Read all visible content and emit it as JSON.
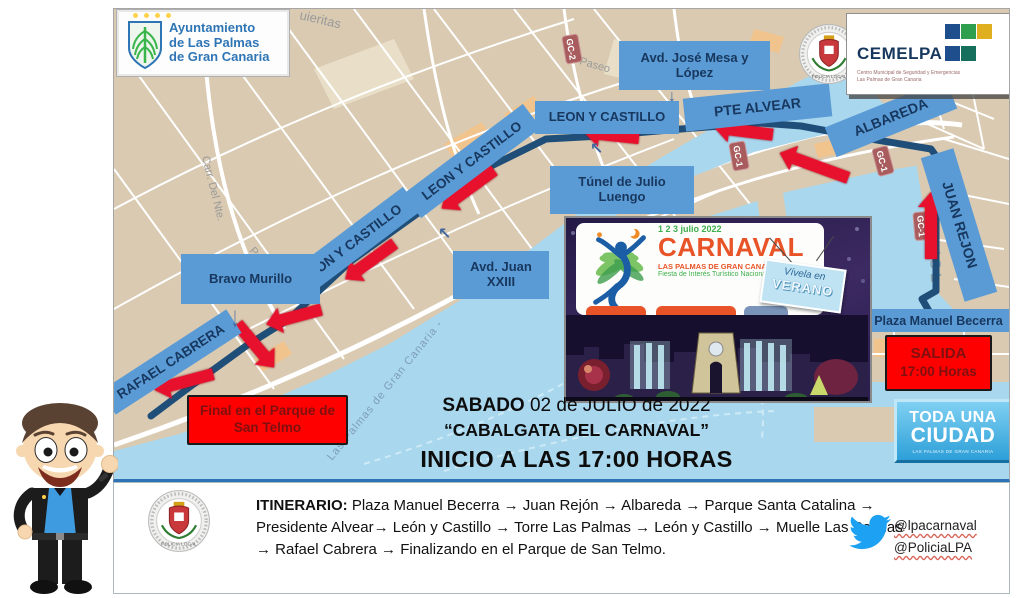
{
  "header": {
    "ayuntamiento": {
      "line1": "Ayuntamiento",
      "line2": "de Las Palmas",
      "line3": "de Gran Canaria"
    },
    "cemelpa": {
      "name": "CEMELPA",
      "subtitle": "Centro Municipal de Seguridad y Emergencias Las Palmas de Gran Canaria"
    }
  },
  "map": {
    "street_labels": {
      "top": "uieritas",
      "carretera": "Carr. Del Nte.",
      "paseo": "Paseo",
      "watermark": "Las Palmas de Gran Canaria -",
      "isleta": "ISL"
    },
    "road_badges": {
      "gc1": "GC-1",
      "gc2": "GC-2"
    },
    "labels": {
      "jose_mesa": "Avd. José Mesa y López",
      "leon_castillo": "LEON Y CASTILLO",
      "pte_alvear": "PTE ALVEAR",
      "albareda": "ALBAREDA",
      "juan_rejon": "JUAN REJON",
      "tunel": "Túnel de Julio Luengo",
      "juan_xxiii": "Avd. Juan XXIII",
      "bravo_murillo": "Bravo Murillo",
      "rafael_cabrera": "RAFAEL CABRERA",
      "plaza_becerra": "Plaza Manuel Becerra"
    },
    "start_box": {
      "line1": "SALIDA",
      "line2": "17:00 Horas"
    },
    "end_box": {
      "text": "Final en el Parque de San Telmo"
    }
  },
  "poster": {
    "dates": "1 2 3 julio 2022",
    "title": "CARNAVAL",
    "subtitle": "LAS PALMAS DE GRAN CANARIA",
    "tagline": "Fiesta de Interés Turístico Nacional",
    "badge_line1": "Vívela en",
    "badge_line2": "VERANO"
  },
  "event": {
    "date_bold": "SABADO",
    "date_rest": " 02 de JULIO de 2022",
    "name": "“CABALGATA DEL CARNAVAL”",
    "start_line": "INICIO A LAS 17:00 HORAS"
  },
  "toda_ciudad": {
    "line1": "TODA UNA",
    "line2": "CIUDAD",
    "subtitle": "LAS PALMAS DE GRAN CANARIA"
  },
  "itinerary": {
    "label": "ITINERARIO:",
    "text": "Plaza Manuel Becerra → Juan Rejón → Albareda → Parque Santa Catalina → Presidente Alvear→ León y Castillo → Torre Las Palmas → León y Castillo → Muelle Las Palmas → Rafael Cabrera → Finalizando en el Parque de San Telmo."
  },
  "social": {
    "handle1": "@lpacarnaval",
    "handle2": "@PoliciaLPA"
  },
  "badge_text": {
    "policia": "POLICIA LOCAL"
  },
  "icons": {
    "down_arrow": "↓",
    "upleft_arrow": "↖"
  },
  "colors": {
    "label_blue": "#5b9bd5",
    "label_text": "#17375e",
    "route_blue": "#1f4e79",
    "arrow_red": "#e8112d",
    "alert_red": "#fe0000",
    "alert_text": "#7f1010",
    "water": "#a8d7ee",
    "land": "#d9cab1",
    "road_badge": "#a95c5e",
    "twitter_blue": "#1da1f2"
  }
}
